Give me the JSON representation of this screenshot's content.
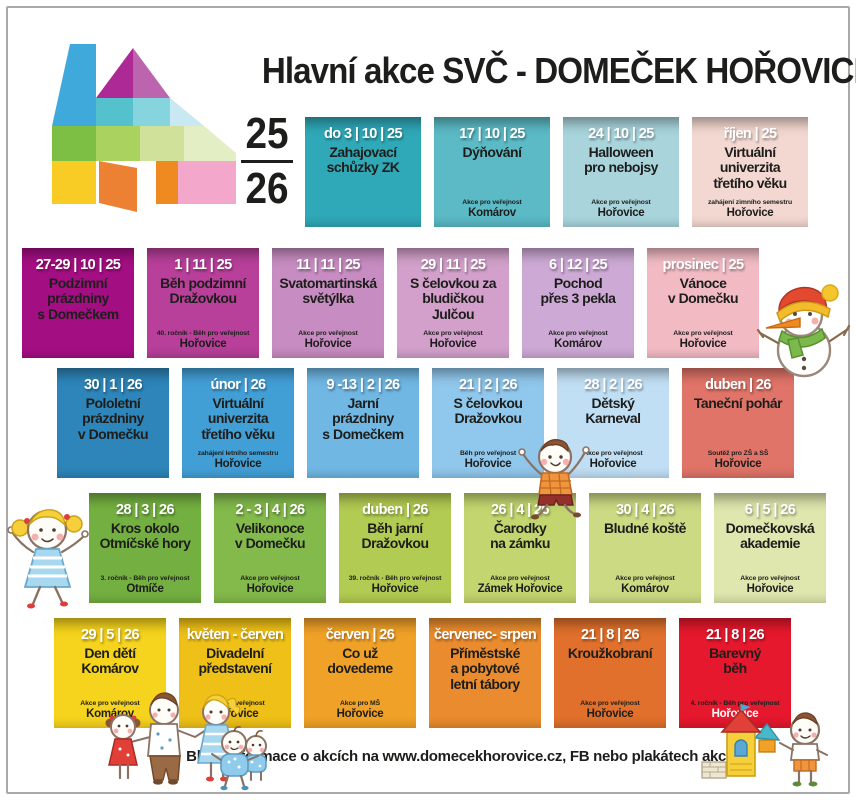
{
  "header": {
    "title": "Hlavní akce SVČ - DOMEČEK HOŘOVICE",
    "year_top": "25",
    "year_bottom": "26"
  },
  "footer": {
    "info": "Bližší informace o akcích na www.domecekhorovice.cz, FB nebo plakátech akcí."
  },
  "colors": {
    "text": "#1d1d1b",
    "date_text": "#ffffff",
    "frame_border": "#a9a9a9"
  },
  "decorations": [
    "house-logo",
    "snowman",
    "jumping-girl",
    "jumping-boy",
    "family",
    "toddler",
    "boy-building-house"
  ],
  "rows": [
    {
      "cards": [
        {
          "date": "do 3 | 10 | 25",
          "title": "Zahajovací\nschůzky ZK",
          "note": "",
          "location": "",
          "bg": "#2fa8b7"
        },
        {
          "date": "17 | 10 | 25",
          "title": "Dýňování",
          "note": "Akce pro veřejnost",
          "location": "Komárov",
          "bg": "#5bbac5"
        },
        {
          "date": "24 | 10 | 25",
          "title": "Halloween\npro nebojsy",
          "note": "Akce pro veřejnost",
          "location": "Hořovice",
          "bg": "#a9d4dc"
        },
        {
          "date": "říjen | 25",
          "title": "Virtuální\nuniverzita\ntřetího věku",
          "note": "zahájení zimního semestru",
          "location": "Hořovice",
          "bg": "#f3d8d1"
        }
      ]
    },
    {
      "cards": [
        {
          "date": "27-29 | 10 | 25",
          "title": "Podzimní\nprázdniny\ns Domečkem",
          "note": "",
          "location": "",
          "bg": "#a40e83"
        },
        {
          "date": "1 | 11 | 25",
          "title": "Běh podzimní\nDražovkou",
          "note": "40. ročník - Běh pro veřejnost",
          "location": "Hořovice",
          "bg": "#b83f9a"
        },
        {
          "date": "11 | 11 | 25",
          "title": "Svatomartinská\nsvětýlka",
          "note": "Akce pro veřejnost",
          "location": "Hořovice",
          "bg": "#c78cc1"
        },
        {
          "date": "29 | 11 | 25",
          "title": "S čelovkou za\nbludičkou Julčou",
          "note": "Akce pro veřejnost",
          "location": "Hořovice",
          "bg": "#d2a0ca"
        },
        {
          "date": "6 | 12 | 25",
          "title": "Pochod\npřes 3 pekla",
          "note": "Akce pro veřejnost",
          "location": "Komárov",
          "bg": "#cda9d5"
        },
        {
          "date": "prosinec | 25",
          "title": "Vánoce\nv Domečku",
          "note": "Akce pro veřejnost",
          "location": "Hořovice",
          "bg": "#f2bbc4"
        }
      ]
    },
    {
      "cards": [
        {
          "date": "30 | 1 | 26",
          "title": "Pololetní\nprázdniny\nv Domečku",
          "note": "",
          "location": "",
          "bg": "#2d85b9"
        },
        {
          "date": "únor | 26",
          "title": "Virtuální\nuniverzita\ntřetího věku",
          "note": "zahájení letního semestru",
          "location": "Hořovice",
          "bg": "#429fd6"
        },
        {
          "date": "9 -13 | 2 | 26",
          "title": "Jarní\nprázdniny\ns Domečkem",
          "note": "",
          "location": "",
          "bg": "#70b7e3"
        },
        {
          "date": "21 | 2 | 26",
          "title": "S čelovkou\nDražovkou",
          "note": "Běh pro veřejnost",
          "location": "Hořovice",
          "bg": "#90c7ec"
        },
        {
          "date": "28 | 2 | 26",
          "title": "Dětský\nKarneval",
          "note": "Akce pro veřejnost",
          "location": "Hořovice",
          "bg": "#c1dff4"
        },
        {
          "date": "duben | 26",
          "title": "Taneční pohár",
          "note": "Soutěž pro ZŠ a SŠ",
          "location": "Hořovice",
          "bg": "#e07468"
        }
      ]
    },
    {
      "cards": [
        {
          "date": "28 | 3 | 26",
          "title": "Kros okolo\nOtmíčské hory",
          "note": "3. ročník - Běh pro veřejnost",
          "location": "Otmíče",
          "bg": "#74b041"
        },
        {
          "date": "2 - 3 | 4 | 26",
          "title": "Velikonoce\nv Domečku",
          "note": "Akce pro veřejnost",
          "location": "Hořovice",
          "bg": "#83ba4b"
        },
        {
          "date": "duben | 26",
          "title": "Běh jarní\nDražovkou",
          "note": "39. ročník - Běh pro veřejnost",
          "location": "Hořovice",
          "bg": "#b2cb52"
        },
        {
          "date": "26 | 4 | 26",
          "title": "Čarodky\nna zámku",
          "note": "Akce pro veřejnost",
          "location": "Zámek Hořovice",
          "bg": "#c3d56e"
        },
        {
          "date": "30 | 4 | 26",
          "title": "Bludné koště",
          "note": "Akce pro veřejnost",
          "location": "Komárov",
          "bg": "#ccda83"
        },
        {
          "date": "6 | 5 | 26",
          "title": "Domečkovská\nakademie",
          "note": "Akce pro veřejnost",
          "location": "Hořovice",
          "bg": "#dfe7ae"
        }
      ]
    },
    {
      "cards": [
        {
          "date": "29 | 5 | 26",
          "title": "Den dětí\nKomárov",
          "note": "Akce pro veřejnost",
          "location": "Komárov",
          "bg": "#f6d31d"
        },
        {
          "date": "květen - červen",
          "title": "Divadelní\npředstavení",
          "note": "Akce pro veřejnost",
          "location": "Hořovice",
          "bg": "#efc017"
        },
        {
          "date": "červen | 26",
          "title": "Co už dovedeme",
          "note": "Akce pro MŠ",
          "location": "Hořovice",
          "bg": "#f0a127"
        },
        {
          "date": "červenec- srpen",
          "title": "Příměstské\na pobytové\nletní tábory",
          "note": "",
          "location": "",
          "bg": "#e98b2e"
        },
        {
          "date": "21 | 8 | 26",
          "title": "Kroužkobraní",
          "note": "Akce pro veřejnost",
          "location": "Hořovice",
          "bg": "#e0702b"
        },
        {
          "date": "21 | 8 | 26",
          "title": "Barevný\nběh",
          "note": "4. ročník - Běh pro veřejnost",
          "location": "Hořovice",
          "bg": "#e5182d",
          "location_color": "#ffffff"
        }
      ]
    }
  ]
}
